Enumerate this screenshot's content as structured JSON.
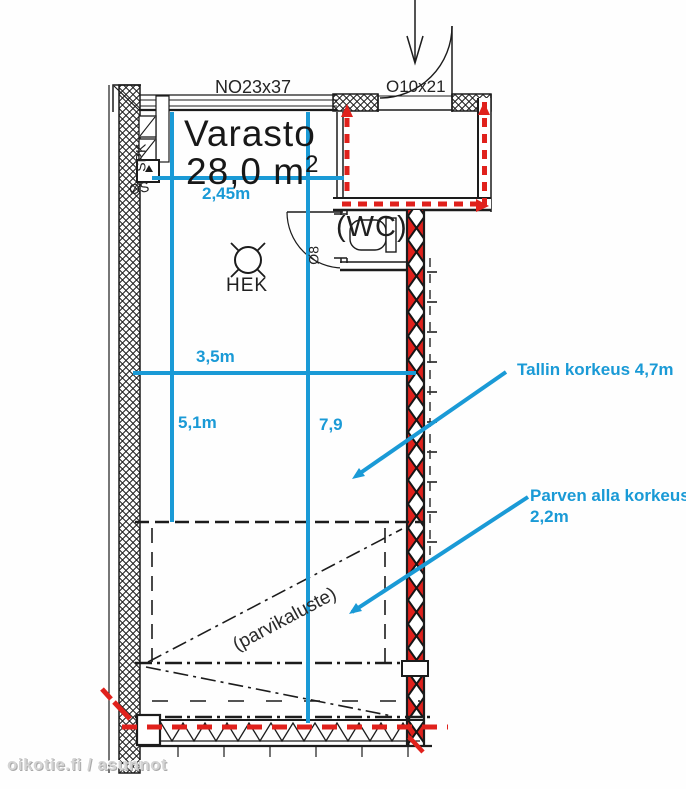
{
  "source": {
    "watermark": "oikotie.fi / asunnot"
  },
  "plan": {
    "room": {
      "name": "Varasto",
      "area_value": "28,0 m",
      "area_sup": "2"
    },
    "labels": {
      "window": "NO23x37",
      "entry_door": "O10x21",
      "wc": "(WC)",
      "wc_door": "Ø8",
      "ceiling_fixture": "HEK",
      "sprinkler_riser": "SPK",
      "electrical": "ØS",
      "loft_furniture": "(parvikaluste)"
    },
    "dimensions": {
      "upper_width": "2,45m",
      "mid_width": "3,5m",
      "left_height": "5,1m",
      "right_height": "7,9"
    },
    "annotations": {
      "hall_height": "Tallin korkeus 4,7m",
      "under_loft_line1": "Parven alla korkeus",
      "under_loft_line2": "2,2m"
    },
    "colors": {
      "dimension_blue": "#1a9ad6",
      "escape_red": "#e0211c",
      "drawing_black": "#1c1c1c",
      "watermark_gray": "#d4d4d4"
    }
  }
}
